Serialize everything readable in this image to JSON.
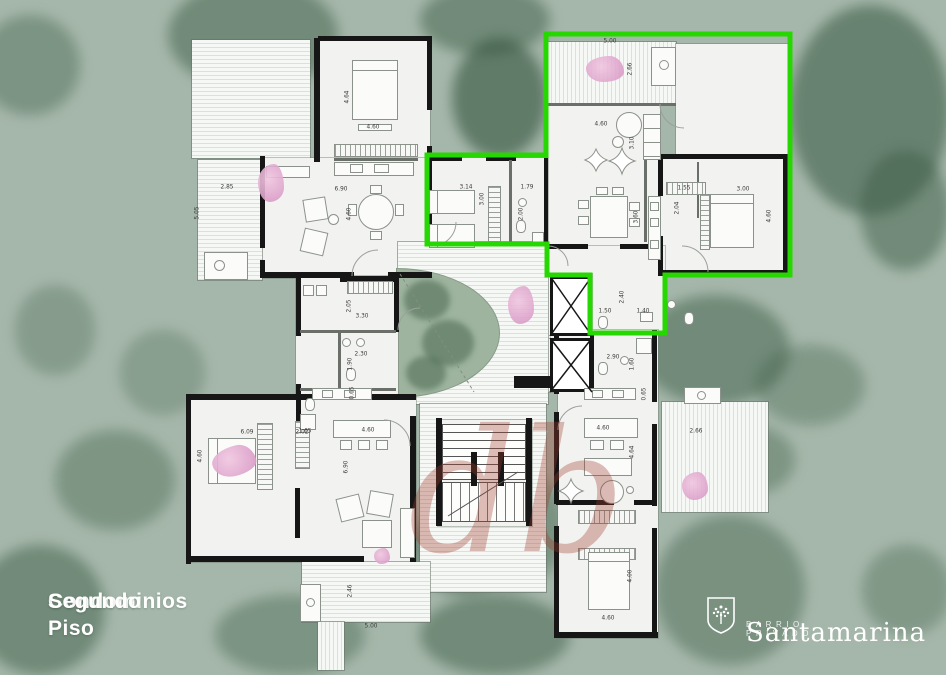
{
  "title": {
    "line1": "Condominios",
    "line2": "Segundo Piso"
  },
  "brand": {
    "name": "Santamarina",
    "tagline": "BARRIO PRIVADO",
    "logo_icon": "tree-shield-icon"
  },
  "watermark": {
    "text": "db"
  },
  "plan": {
    "highlight_color": "#26d701",
    "background_color": "#a5b7aa",
    "wall_color": "#161616",
    "accent_pink": "#e5b4d4",
    "dimension_labels": [
      {
        "t": "4.64",
        "x": 347,
        "y": 97,
        "v": true
      },
      {
        "t": "4.60",
        "x": 373,
        "y": 127
      },
      {
        "t": "6.90",
        "x": 341,
        "y": 189
      },
      {
        "t": "4.60",
        "x": 349,
        "y": 214,
        "v": true
      },
      {
        "t": "2.85",
        "x": 227,
        "y": 187
      },
      {
        "t": "5.05",
        "x": 197,
        "y": 213,
        "v": true
      },
      {
        "t": "5.00",
        "x": 610,
        "y": 41
      },
      {
        "t": "2.66",
        "x": 630,
        "y": 69,
        "v": true
      },
      {
        "t": "4.60",
        "x": 601,
        "y": 124
      },
      {
        "t": "3.10",
        "x": 632,
        "y": 143,
        "v": true
      },
      {
        "t": "3.14",
        "x": 466,
        "y": 187
      },
      {
        "t": "3.00",
        "x": 482,
        "y": 199,
        "v": true
      },
      {
        "t": "1.79",
        "x": 527,
        "y": 187
      },
      {
        "t": "2.00",
        "x": 521,
        "y": 214,
        "v": true
      },
      {
        "t": "3.60",
        "x": 636,
        "y": 217,
        "v": true
      },
      {
        "t": "1.55",
        "x": 684,
        "y": 188
      },
      {
        "t": "2.04",
        "x": 677,
        "y": 208,
        "v": true
      },
      {
        "t": "3.00",
        "x": 743,
        "y": 189
      },
      {
        "t": "4.60",
        "x": 769,
        "y": 216,
        "v": true
      },
      {
        "t": "1.50",
        "x": 605,
        "y": 311
      },
      {
        "t": "1.40",
        "x": 643,
        "y": 311
      },
      {
        "t": "2.40",
        "x": 622,
        "y": 297,
        "v": true
      },
      {
        "t": "3.30",
        "x": 362,
        "y": 316
      },
      {
        "t": "2.05",
        "x": 349,
        "y": 306,
        "v": true
      },
      {
        "t": "2.30",
        "x": 361,
        "y": 354
      },
      {
        "t": "1.90",
        "x": 350,
        "y": 364,
        "v": true
      },
      {
        "t": "0.65",
        "x": 352,
        "y": 393,
        "v": true
      },
      {
        "t": "1.65",
        "x": 305,
        "y": 431
      },
      {
        "t": "6.09",
        "x": 247,
        "y": 432
      },
      {
        "t": "2.02",
        "x": 302,
        "y": 432
      },
      {
        "t": "4.60",
        "x": 200,
        "y": 456,
        "v": true
      },
      {
        "t": "4.60",
        "x": 368,
        "y": 430
      },
      {
        "t": "6.90",
        "x": 346,
        "y": 467,
        "v": true
      },
      {
        "t": "2.46",
        "x": 350,
        "y": 591,
        "v": true
      },
      {
        "t": "5.00",
        "x": 371,
        "y": 626
      },
      {
        "t": "2.90",
        "x": 613,
        "y": 357
      },
      {
        "t": "1.60",
        "x": 632,
        "y": 364,
        "v": true
      },
      {
        "t": "0.65",
        "x": 644,
        "y": 394,
        "v": true
      },
      {
        "t": "4.60",
        "x": 603,
        "y": 428
      },
      {
        "t": "4.64",
        "x": 632,
        "y": 452,
        "v": true
      },
      {
        "t": "2.66",
        "x": 696,
        "y": 431
      },
      {
        "t": "4.00",
        "x": 630,
        "y": 576,
        "v": true
      },
      {
        "t": "4.60",
        "x": 608,
        "y": 618
      }
    ]
  }
}
